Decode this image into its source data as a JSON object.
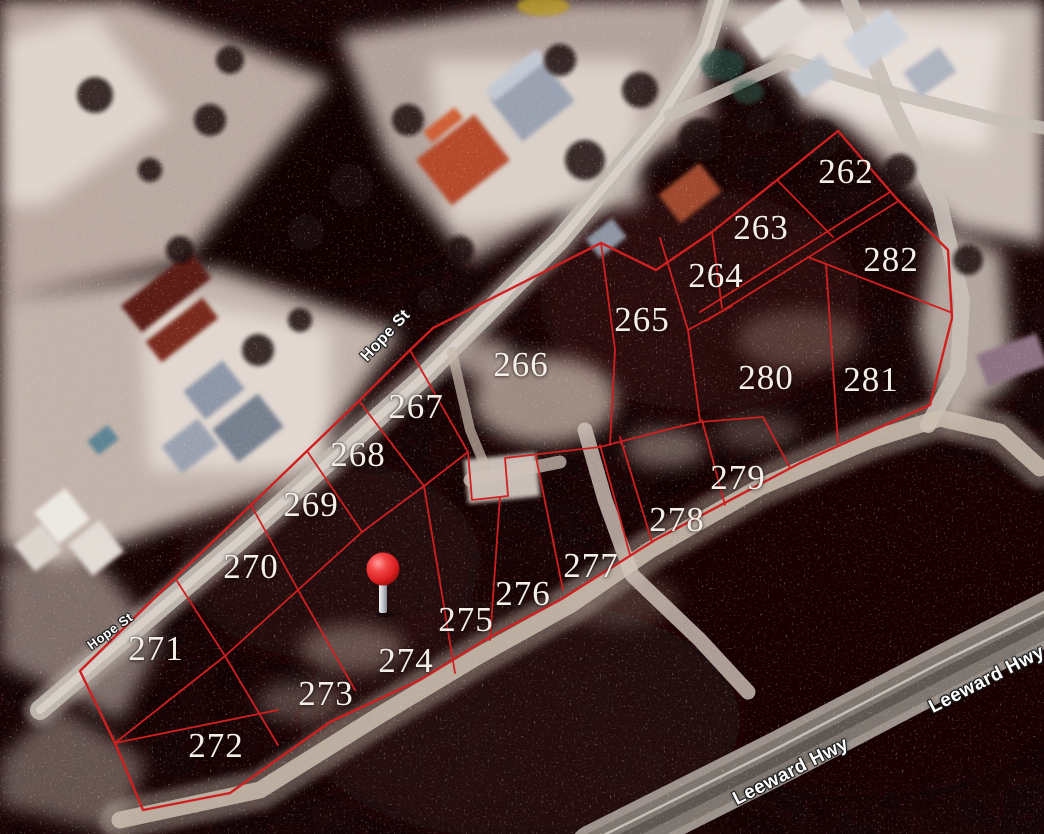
{
  "map": {
    "description": "Satellite view with red subdivision parcel overlay, Hope St and Leeward Hwy",
    "colors": {
      "parcel_line": "#cf2020",
      "lot_label": "#f3efe8",
      "street_label": "#ffffff",
      "road": "#c2bab2",
      "highway": "#857d76",
      "pin_red": "#e8201f"
    },
    "lots": [
      {
        "number": "262",
        "x": 846,
        "y": 172
      },
      {
        "number": "263",
        "x": 761,
        "y": 228
      },
      {
        "number": "282",
        "x": 891,
        "y": 260
      },
      {
        "number": "264",
        "x": 716,
        "y": 276
      },
      {
        "number": "265",
        "x": 642,
        "y": 320
      },
      {
        "number": "266",
        "x": 521,
        "y": 365
      },
      {
        "number": "280",
        "x": 766,
        "y": 378
      },
      {
        "number": "281",
        "x": 871,
        "y": 380
      },
      {
        "number": "267",
        "x": 416,
        "y": 407
      },
      {
        "number": "268",
        "x": 358,
        "y": 455
      },
      {
        "number": "269",
        "x": 311,
        "y": 505
      },
      {
        "number": "279",
        "x": 738,
        "y": 478
      },
      {
        "number": "278",
        "x": 677,
        "y": 520
      },
      {
        "number": "277",
        "x": 591,
        "y": 566
      },
      {
        "number": "270",
        "x": 251,
        "y": 567
      },
      {
        "number": "276",
        "x": 523,
        "y": 594
      },
      {
        "number": "275",
        "x": 466,
        "y": 620
      },
      {
        "number": "271",
        "x": 156,
        "y": 649
      },
      {
        "number": "274",
        "x": 406,
        "y": 661
      },
      {
        "number": "273",
        "x": 326,
        "y": 694
      },
      {
        "number": "272",
        "x": 216,
        "y": 746
      }
    ],
    "streets": [
      {
        "name": "Hope St",
        "x": 386,
        "y": 336,
        "angle": -47,
        "size": 16
      },
      {
        "name": "Hope St",
        "x": 110,
        "y": 631,
        "angle": -36,
        "size": 13
      },
      {
        "name": "Leeward Hwy",
        "x": 791,
        "y": 772,
        "angle": -27,
        "size": 19
      },
      {
        "name": "Leeward Hwy",
        "x": 987,
        "y": 680,
        "angle": -27,
        "size": 19
      }
    ],
    "marker": {
      "type": "red-pin",
      "x": 383,
      "y": 569
    }
  }
}
